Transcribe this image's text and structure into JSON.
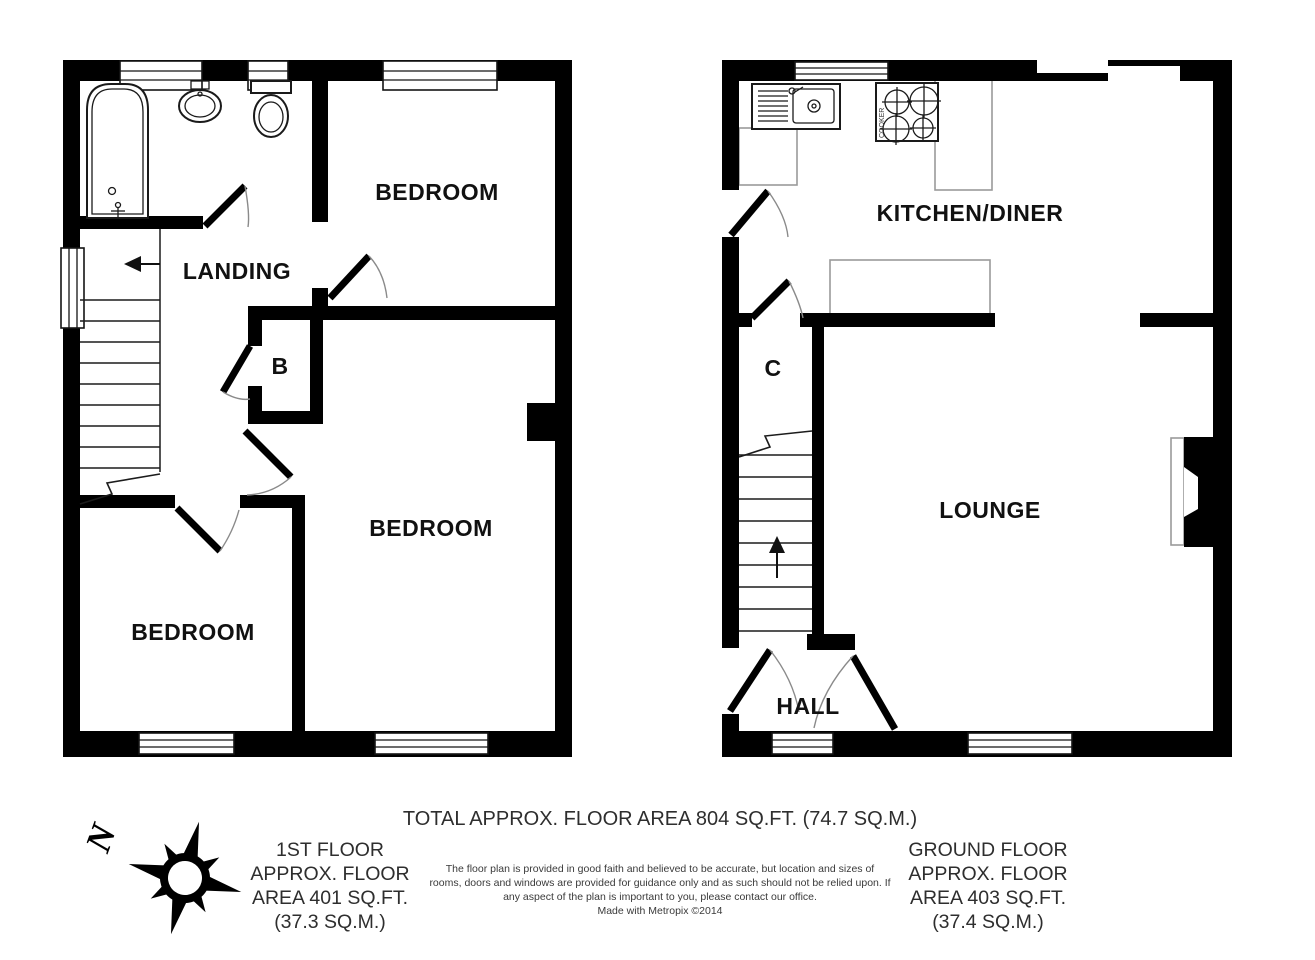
{
  "floors": {
    "first": {
      "labels": {
        "bedroom_top": "BEDROOM",
        "landing": "LANDING",
        "cupboard": "B",
        "bedroom_middle": "BEDROOM",
        "bedroom_bottom": "BEDROOM"
      },
      "area_lines": [
        "1ST FLOOR",
        "APPROX. FLOOR",
        "AREA 401 SQ.FT.",
        "(37.3 SQ.M.)"
      ]
    },
    "ground": {
      "labels": {
        "kitchen_diner": "KITCHEN/DINER",
        "cupboard": "C",
        "lounge": "LOUNGE",
        "hall": "HALL"
      },
      "cooker_label": "COOKER",
      "area_lines": [
        "GROUND FLOOR",
        "APPROX. FLOOR",
        "AREA 403 SQ.FT.",
        "(37.4 SQ.M.)"
      ]
    }
  },
  "summary": {
    "total_area": "TOTAL APPROX. FLOOR AREA 804 SQ.FT. (74.7 SQ.M.)",
    "disclaimer_lines": [
      "The floor plan is provided in good faith and believed to be accurate, but location and sizes of",
      "rooms, doors and windows are provided for guidance only and as such should not be relied upon. If",
      "any aspect of the plan is important to you, please contact our office.",
      "Made with Metropix ©2014"
    ]
  },
  "compass": {
    "north_label": "N"
  },
  "colors": {
    "wall": "#000000",
    "counter_outline": "#9a9a9a",
    "label_text": "#111111",
    "area_text": "#2e2e2e",
    "disclaimer_text": "#3a3a3a"
  }
}
